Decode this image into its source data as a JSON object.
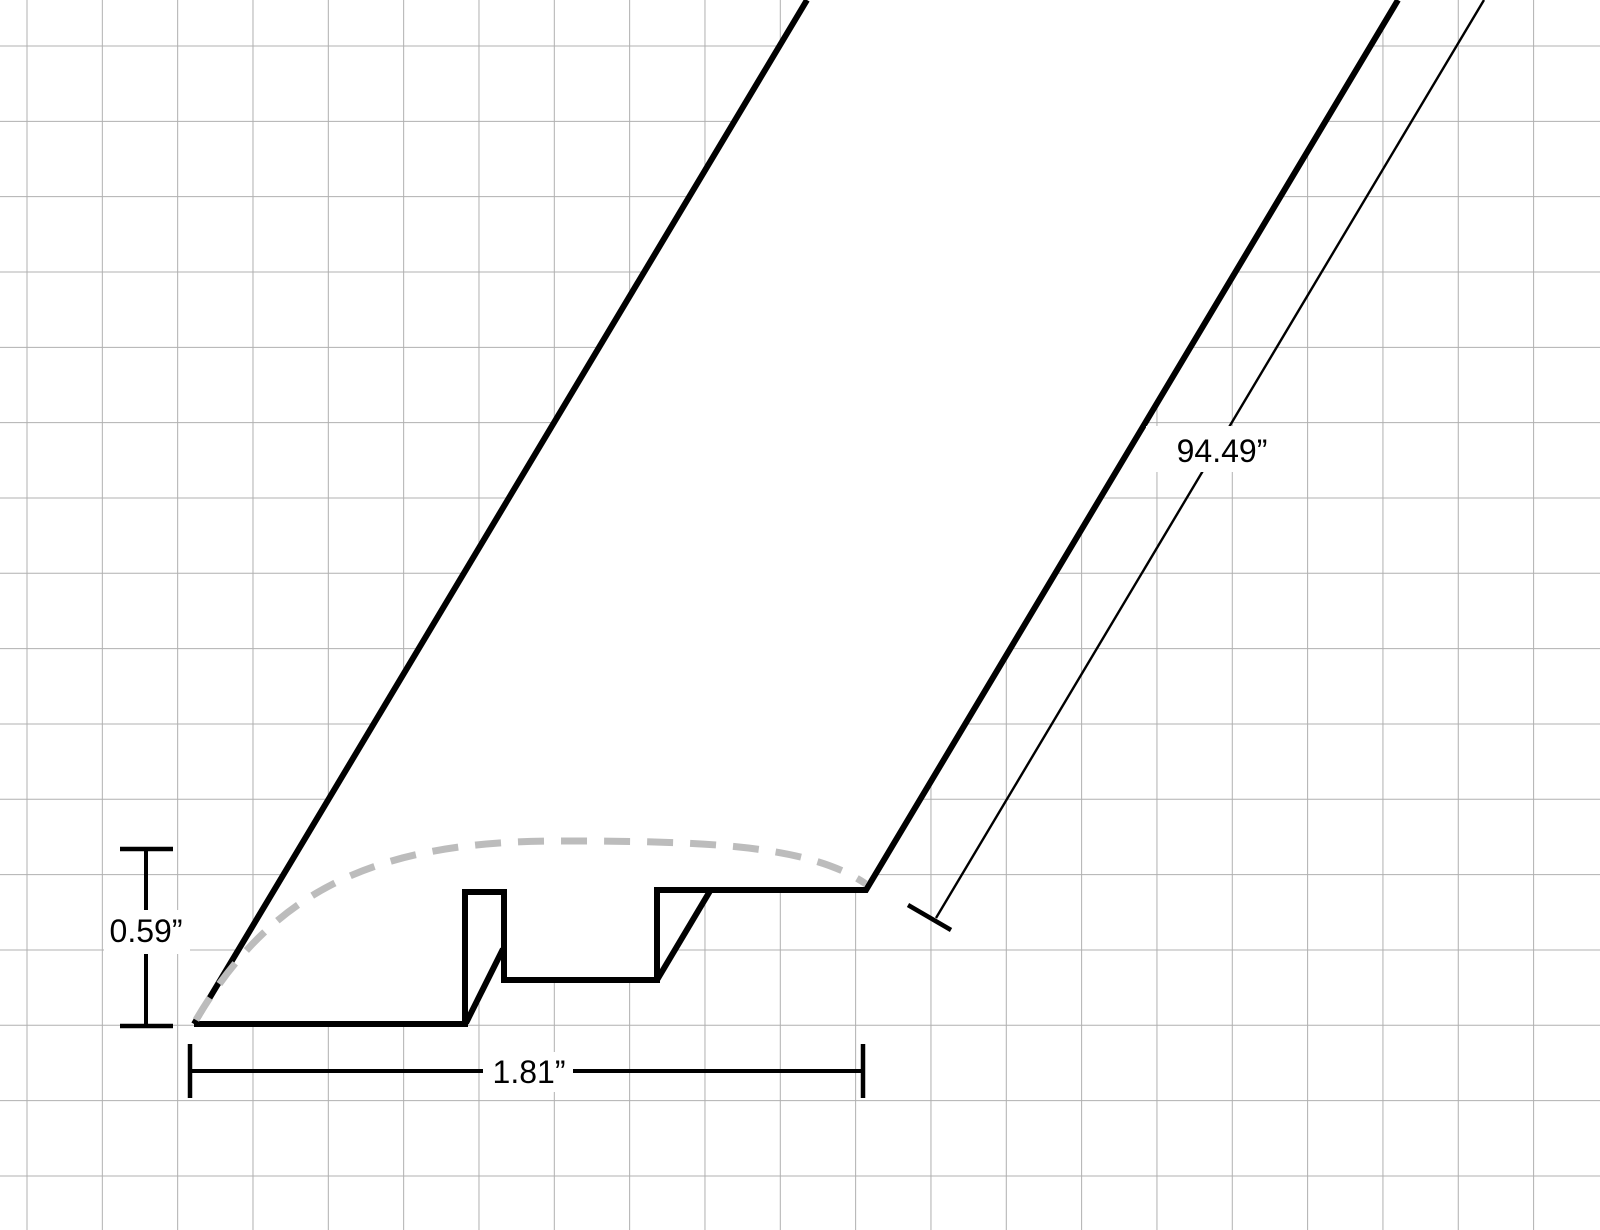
{
  "canvas": {
    "width": 1600,
    "height": 1230,
    "background": "#ffffff"
  },
  "grid": {
    "spacing": 75.33,
    "offset_x": 27,
    "offset_y": 46,
    "color": "#b0b0b0",
    "stroke_width": 1
  },
  "colors": {
    "outline": "#000000",
    "hidden_surface_dash": "#bcbcbc",
    "dimension_line": "#000000",
    "label_text": "#000000",
    "label_background": "#ffffff",
    "body_fill": "#ffffff"
  },
  "labels": {
    "height": "0.59”",
    "width": "1.81”",
    "length": "94.49”"
  },
  "svg_geometry": {
    "body-fill-main": {
      "points": "194,1024 807,0 1398,0 866,890 657,890 657,980 504,980 504,892 465,892 465,1024",
      "fill": "#ffffff"
    },
    "body-fill-slot": {
      "points": "464,892 505,892 505,948 467,1024 464,1024",
      "fill": "#ffffff"
    },
    "body-fill-channel": {
      "points": "656,890 711,890 656,981",
      "fill": "#ffffff"
    },
    "left-extrusion-edge": {
      "d": "M194,1024 L807,0",
      "stroke": "#000000",
      "stroke-width": "6",
      "fill": "none"
    },
    "profile-outline": {
      "d": "M1398,0 L866,890 L657,890 L657,980 L504,980 L504,892 L465,892 L465,1024 L194,1024",
      "stroke": "#000000",
      "stroke-width": "6",
      "fill": "none",
      "stroke-linejoin": "miter"
    },
    "hidden-edge-slot": {
      "d": "M466,1023 L503,949",
      "stroke": "#000000",
      "stroke-width": "6",
      "fill": "none"
    },
    "hidden-edge-channel": {
      "d": "M657,980 L710,891",
      "stroke": "#000000",
      "stroke-width": "6",
      "fill": "none"
    },
    "surface-curve-dashed": {
      "d": "M196,1020 C274,887 380,841 560,841 C700,841 808,844 866,884",
      "stroke": "#bcbcbc",
      "stroke-width": "7",
      "stroke-dasharray": "26 17",
      "fill": "none"
    },
    "dim-height-line": {
      "d": "M146,849 L146,1026",
      "stroke": "#000000",
      "stroke-width": "4",
      "fill": "none"
    },
    "dim-height-cap-top": {
      "d": "M120,849 L173,849",
      "stroke": "#000000",
      "stroke-width": "4.5",
      "fill": "none"
    },
    "dim-height-cap-bottom": {
      "d": "M120,1026 L173,1026",
      "stroke": "#000000",
      "stroke-width": "4.5",
      "fill": "none"
    },
    "dim-height-label-bg": {
      "x": "104",
      "y": "910",
      "width": "86",
      "height": "44",
      "fill": "#ffffff"
    },
    "dim-height-label": {
      "x": "146",
      "y": "942"
    },
    "dim-width-line": {
      "d": "M190,1071 L863,1071",
      "stroke": "#000000",
      "stroke-width": "4",
      "fill": "none"
    },
    "dim-width-cap-left": {
      "d": "M190,1044 L190,1098",
      "stroke": "#000000",
      "stroke-width": "4.5",
      "fill": "none"
    },
    "dim-width-cap-right": {
      "d": "M863,1044 L863,1098",
      "stroke": "#000000",
      "stroke-width": "4.5",
      "fill": "none"
    },
    "dim-width-label-bg": {
      "x": "483",
      "y": "1052",
      "width": "90",
      "height": "40",
      "fill": "#ffffff"
    },
    "dim-width-label": {
      "x": "529",
      "y": "1083"
    },
    "dim-length-line": {
      "d": "M936,918 L1484,0",
      "stroke": "#000000",
      "stroke-width": "2.4",
      "fill": "none"
    },
    "dim-length-tick": {
      "d": "M908,905 L951,930",
      "stroke": "#000000",
      "stroke-width": "4.5",
      "fill": "none"
    },
    "dim-length-label-bg": {
      "x": "1146",
      "y": "426",
      "width": "152",
      "height": "46",
      "fill": "#ffffff"
    },
    "dim-length-label": {
      "x": "1222",
      "y": "462"
    }
  }
}
